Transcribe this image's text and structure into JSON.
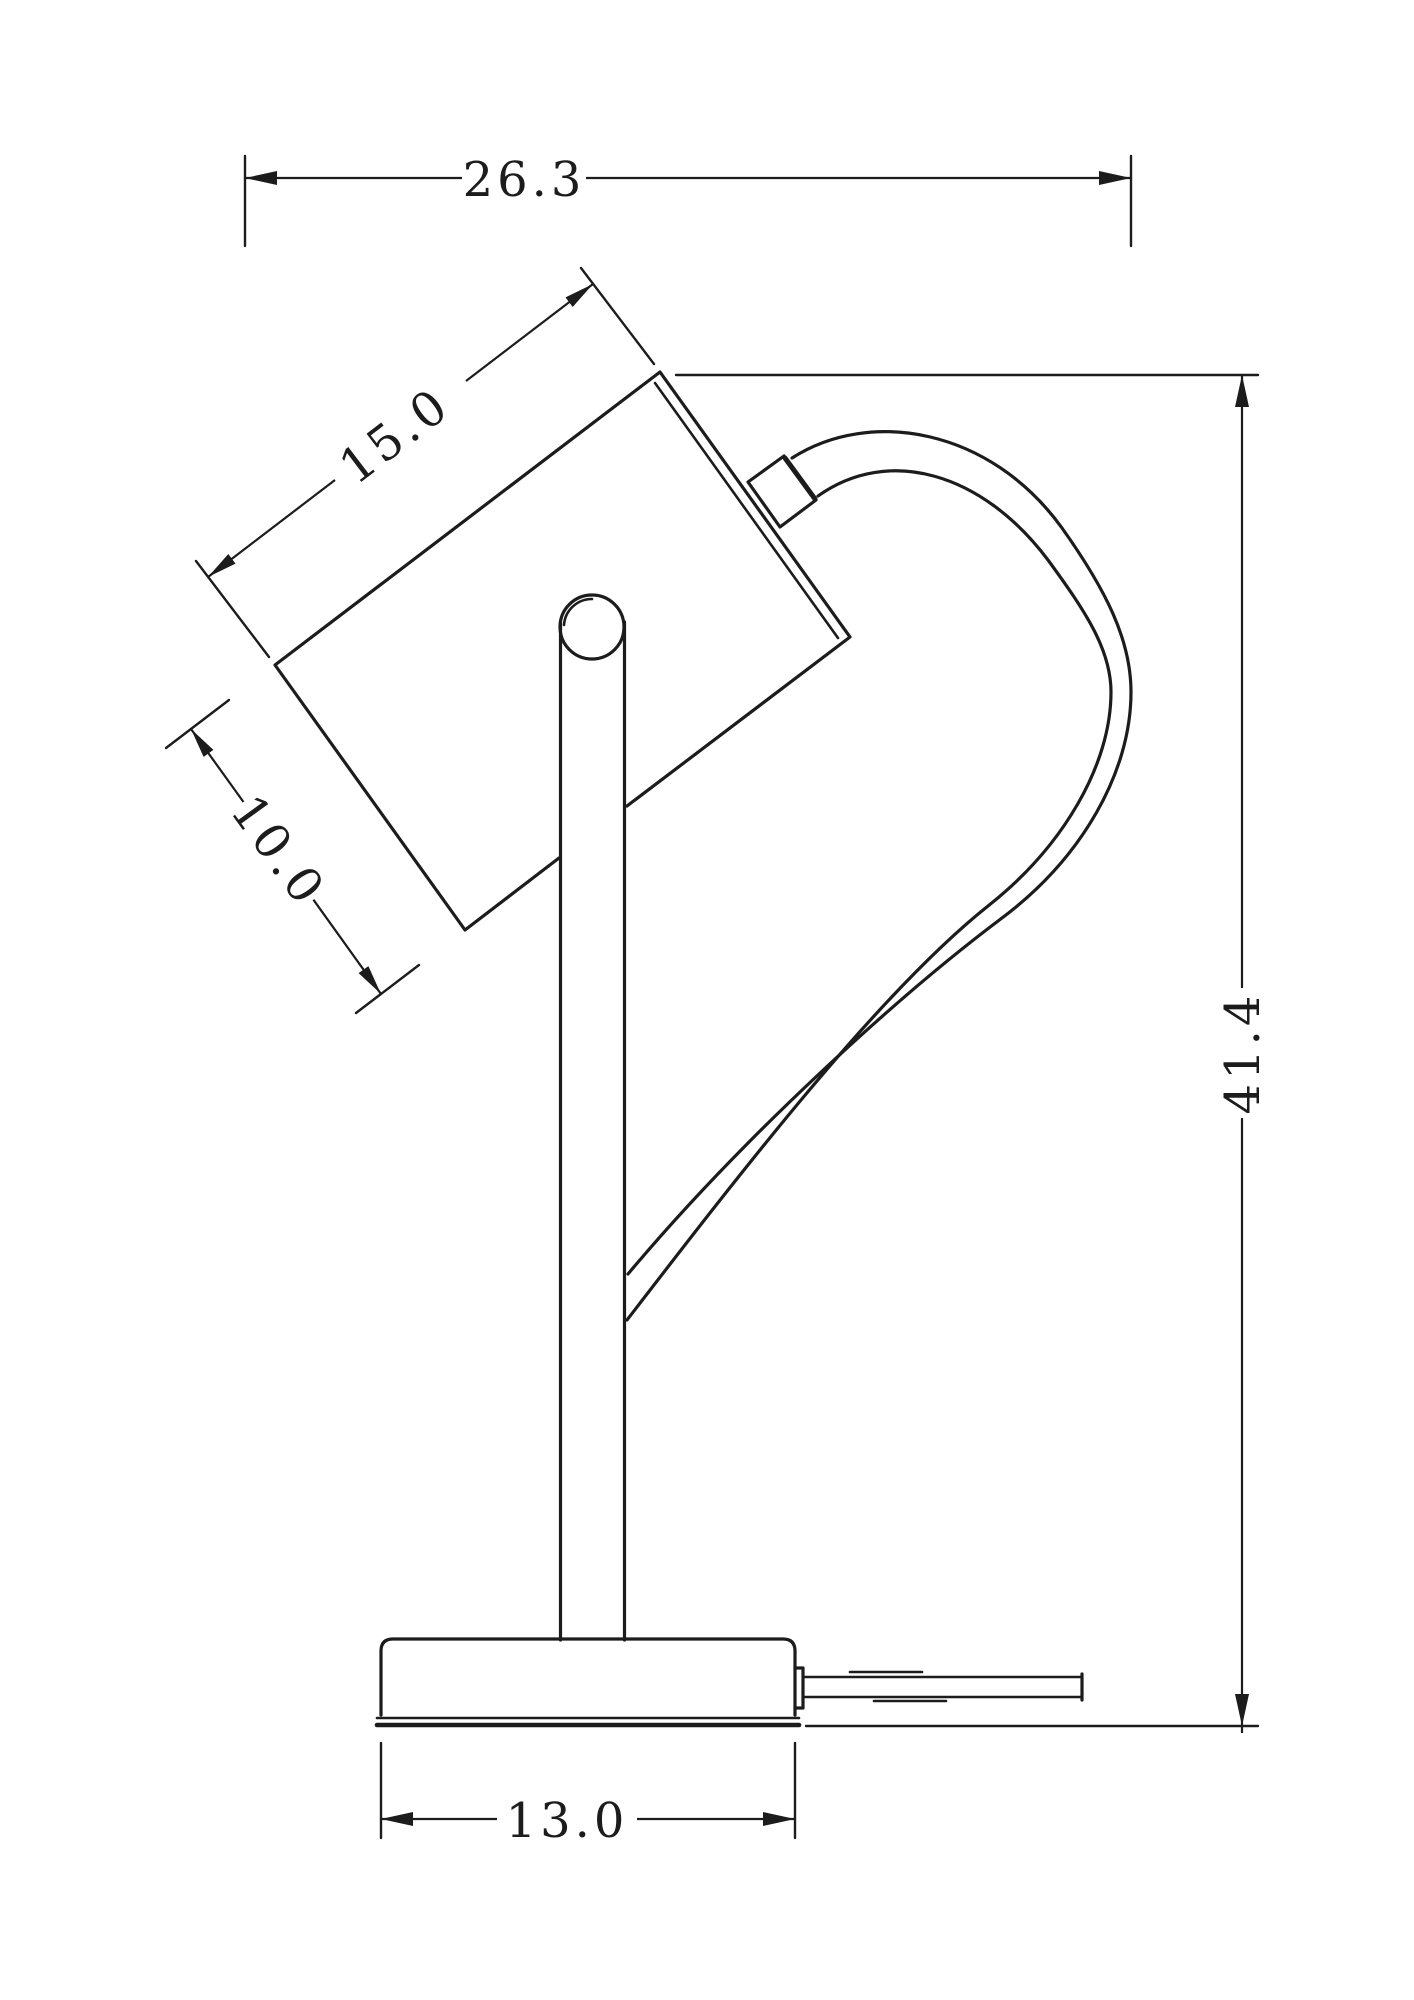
{
  "dimensions": {
    "overall_width": "26.3",
    "head_length": "15.0",
    "head_depth": "10.0",
    "overall_height": "41.4",
    "base_width": "13.0"
  },
  "colors": {
    "line": "#1c1c1c",
    "background": "#ffffff"
  }
}
